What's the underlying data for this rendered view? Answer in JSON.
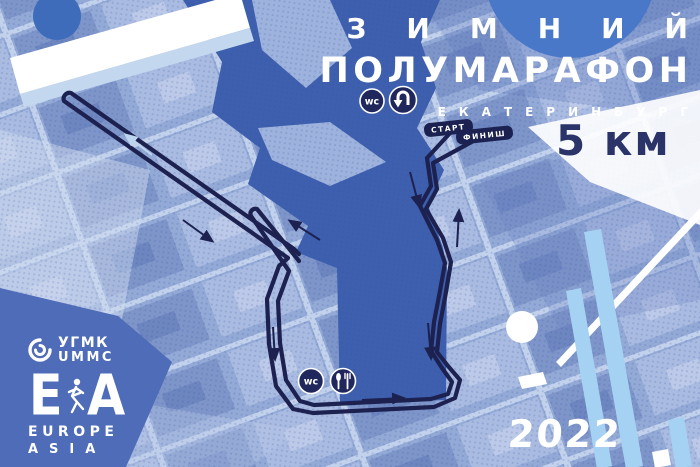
{
  "poster": {
    "title_line1": "ЗИМНИЙ",
    "title_line2": "ПОЛУМАРАФОН",
    "city": "ЕКАТЕРИНБУРГ",
    "distance": "5 км",
    "year": "2022"
  },
  "route": {
    "start_label": "СТАРТ",
    "finish_label": "ФИНИШ",
    "wc_label": "wc"
  },
  "sponsors": {
    "ummc_ru": "УГМК",
    "ummc_en": "UMMC",
    "ea_left": "E",
    "ea_right": "A",
    "europe": "EUROPE",
    "asia": "ASIA"
  },
  "icons": {
    "top": [
      "wc-icon",
      "u-turn-icon"
    ],
    "bottom": [
      "wc-icon",
      "food-icon"
    ],
    "logo": [
      "ummc-swirl-icon",
      "runner-icon"
    ]
  },
  "colors": {
    "map_base": "#8da4d2",
    "water": "#3d5fae",
    "route_navy": "#1d2150",
    "label_navy": "#1b2150",
    "sky_stripe": "#a5d2f2",
    "accent_circle": "#4a78c8",
    "distance_text": "#2b3468",
    "white": "#ffffff"
  }
}
